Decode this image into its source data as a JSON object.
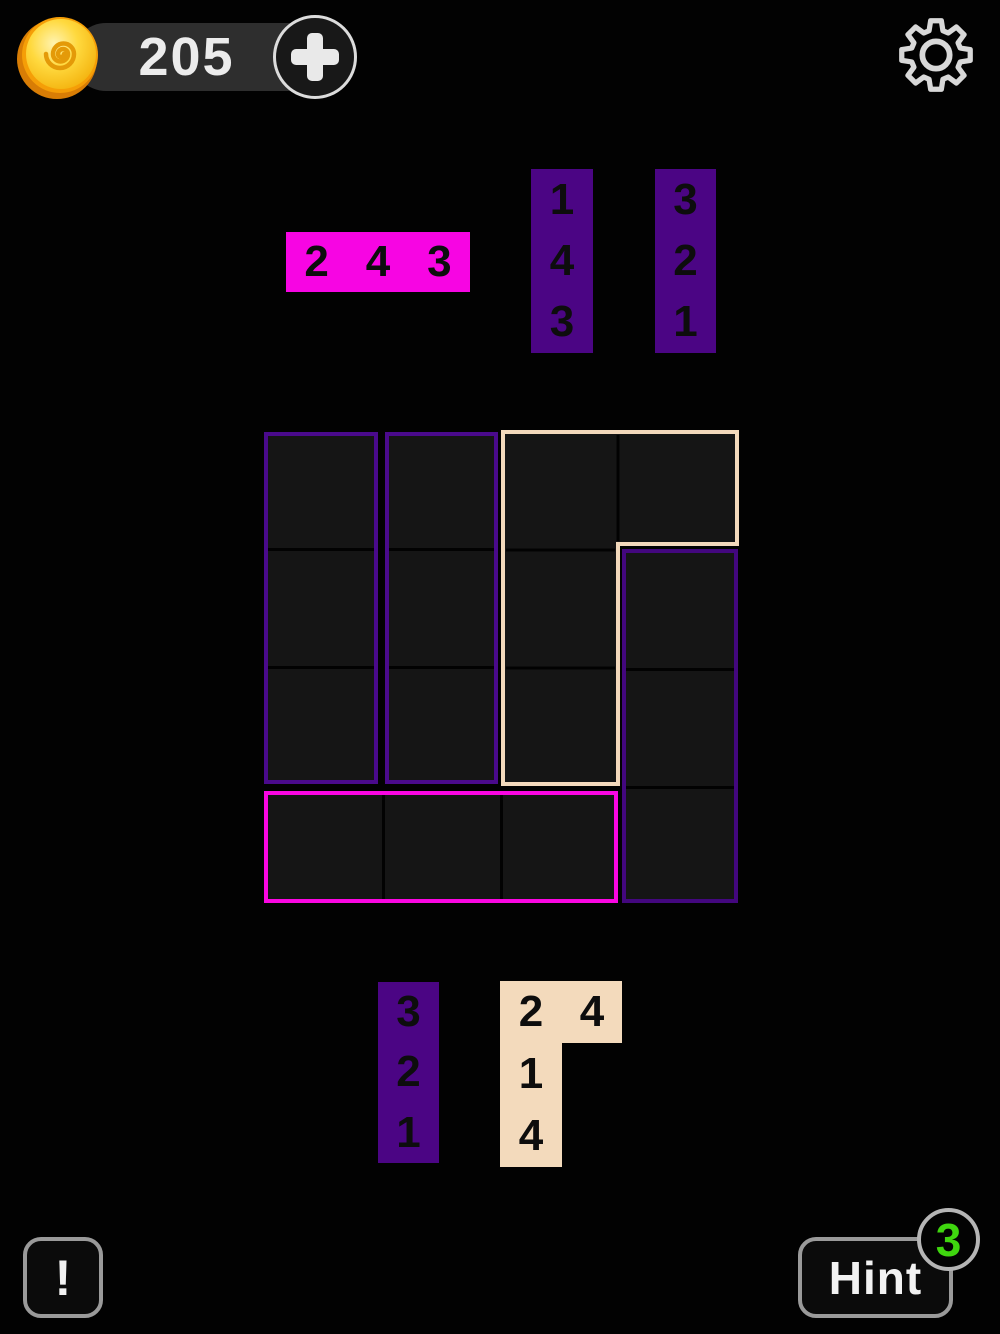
{
  "colors": {
    "background": "#020202",
    "piece_magenta": "#f705e3",
    "piece_purple": "#4b0584",
    "piece_cream": "#f3dabc",
    "board_outline_purple": "#4a0a8c",
    "board_outline_magenta": "#fa06e2",
    "board_outline_cream": "#f3d9bc",
    "board_cell_fill": "#151515",
    "coin_gold": "#ffd83e",
    "hint_badge_green": "#3fd60f"
  },
  "header": {
    "coin_count": "205",
    "plus_button": "+"
  },
  "trays": {
    "top": [
      {
        "id": "piece-2-4-3",
        "shape": "1x3-horizontal",
        "color": "magenta",
        "numbers": [
          "2",
          "4",
          "3"
        ]
      },
      {
        "id": "piece-1-4-3",
        "shape": "3x1-vertical",
        "color": "purple",
        "numbers": [
          "1",
          "4",
          "3"
        ]
      },
      {
        "id": "piece-3-2-1-top",
        "shape": "3x1-vertical",
        "color": "purple",
        "numbers": [
          "3",
          "2",
          "1"
        ]
      }
    ],
    "bottom": [
      {
        "id": "piece-3-2-1-bottom",
        "shape": "3x1-vertical",
        "color": "purple",
        "numbers": [
          "3",
          "2",
          "1"
        ]
      },
      {
        "id": "piece-L",
        "shape": "L-2x1-plus-1x3",
        "color": "cream",
        "numbers": [
          "2",
          "4",
          "1",
          "4"
        ]
      }
    ]
  },
  "board": {
    "grid": "4x4",
    "regions": [
      {
        "name": "column-1-rows-1-3",
        "outline": "purple"
      },
      {
        "name": "column-2-rows-1-3",
        "outline": "purple"
      },
      {
        "name": "L-row-1-cols-3-4-plus-col-3-rows-2-3",
        "outline": "cream"
      },
      {
        "name": "column-4-rows-2-4",
        "outline": "purple"
      },
      {
        "name": "row-4-cols-1-3",
        "outline": "magenta"
      }
    ]
  },
  "footer": {
    "warning_button": "!",
    "hint_button": "Hint",
    "hint_count": "3"
  }
}
